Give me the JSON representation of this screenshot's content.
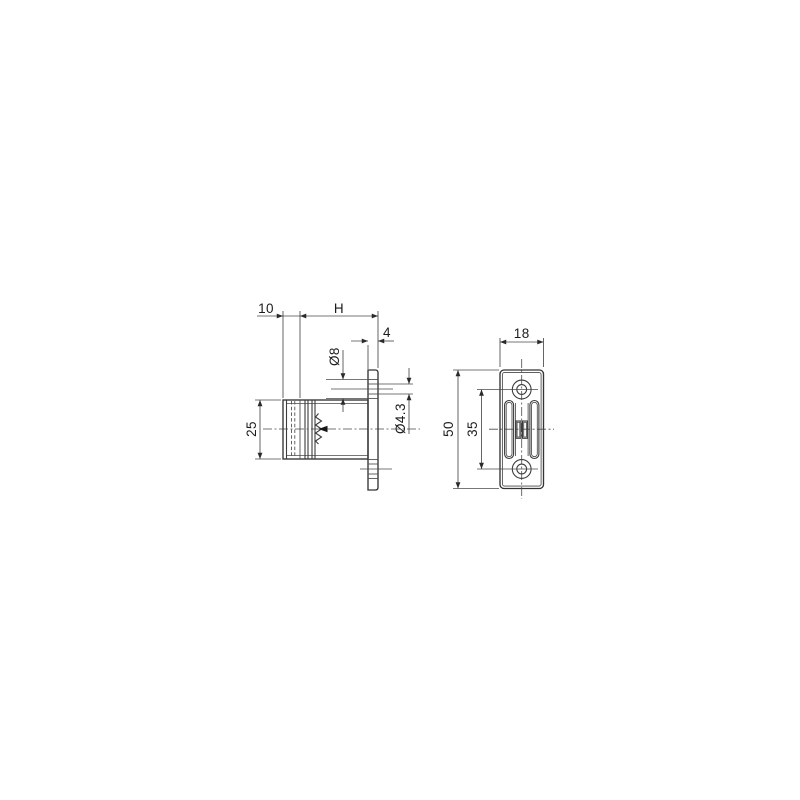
{
  "drawing": {
    "title": "flange-latch-dimension-drawing",
    "colors": {
      "background": "#ffffff",
      "line": "#3c3c3c",
      "text": "#1c1c1c"
    },
    "side_view": {
      "dims": {
        "offset": "10",
        "height_var": "H",
        "flange_thickness": "4",
        "countersink_dia": "Ø8",
        "hole_dia": "Ø4.3",
        "body_dia": "25"
      }
    },
    "front_view": {
      "dims": {
        "plate_width": "18",
        "plate_height": "50",
        "hole_spacing": "35"
      }
    }
  }
}
